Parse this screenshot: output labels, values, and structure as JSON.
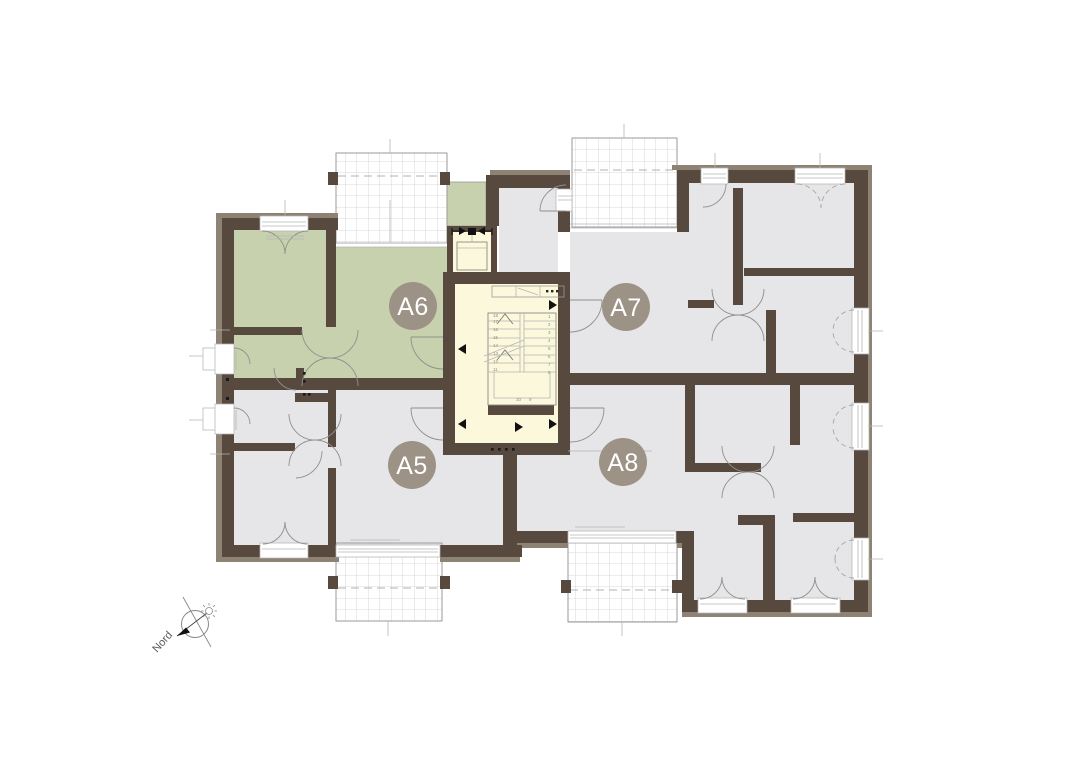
{
  "plan": {
    "units": [
      {
        "id": "A5",
        "label": "A5",
        "highlighted": false
      },
      {
        "id": "A6",
        "label": "A6",
        "highlighted": true
      },
      {
        "id": "A7",
        "label": "A7",
        "highlighted": false
      },
      {
        "id": "A8",
        "label": "A8",
        "highlighted": false
      }
    ],
    "colors": {
      "highlight": "#c8d1ae",
      "floor": "#e6e6e8",
      "stairwell": "#fbf8dc",
      "wall_dark": "#57493d",
      "wall_light": "#8e8275",
      "unit_badge": "#9c9286",
      "badge_text": "#ffffff"
    },
    "compass": {
      "label": "Nord"
    },
    "stairs": {
      "left_numbers": [
        "11",
        "12",
        "13",
        "14",
        "15",
        "16",
        "17",
        "18"
      ],
      "right_numbers": [
        "1",
        "2",
        "3",
        "4",
        "5",
        "6",
        "7",
        "8"
      ],
      "landing_numbers": [
        "10",
        "9"
      ]
    }
  }
}
